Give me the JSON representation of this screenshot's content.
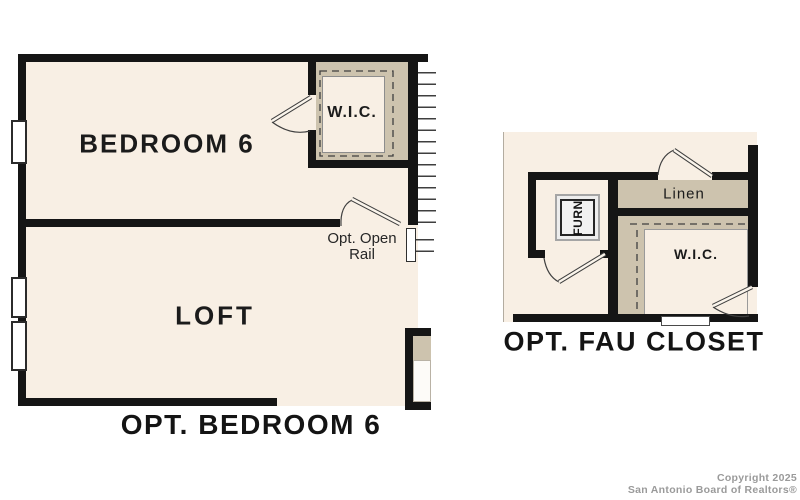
{
  "colors": {
    "page_background": "#ffffff",
    "room_fill": "#f8efe4",
    "shaded_closet_wall": "#cdc3ae",
    "wall": "#151515",
    "line": "#3f3f3f",
    "watermark_text": "#9a9a9a"
  },
  "left_plan": {
    "bedroom_label": "BEDROOM 6",
    "wic_label": "W.I.C.",
    "loft_label": "LOFT",
    "rail_note_line1": "Opt. Open",
    "rail_note_line2": "Rail",
    "caption": "OPT. BEDROOM 6"
  },
  "right_plan": {
    "furnace_label": "FURN",
    "linen_label": "Linen",
    "wic_label": "W.I.C.",
    "caption": "OPT. FAU CLOSET"
  },
  "watermark": {
    "line1": "Copyright 2025",
    "line2": "San Antonio Board of Realtors®"
  }
}
